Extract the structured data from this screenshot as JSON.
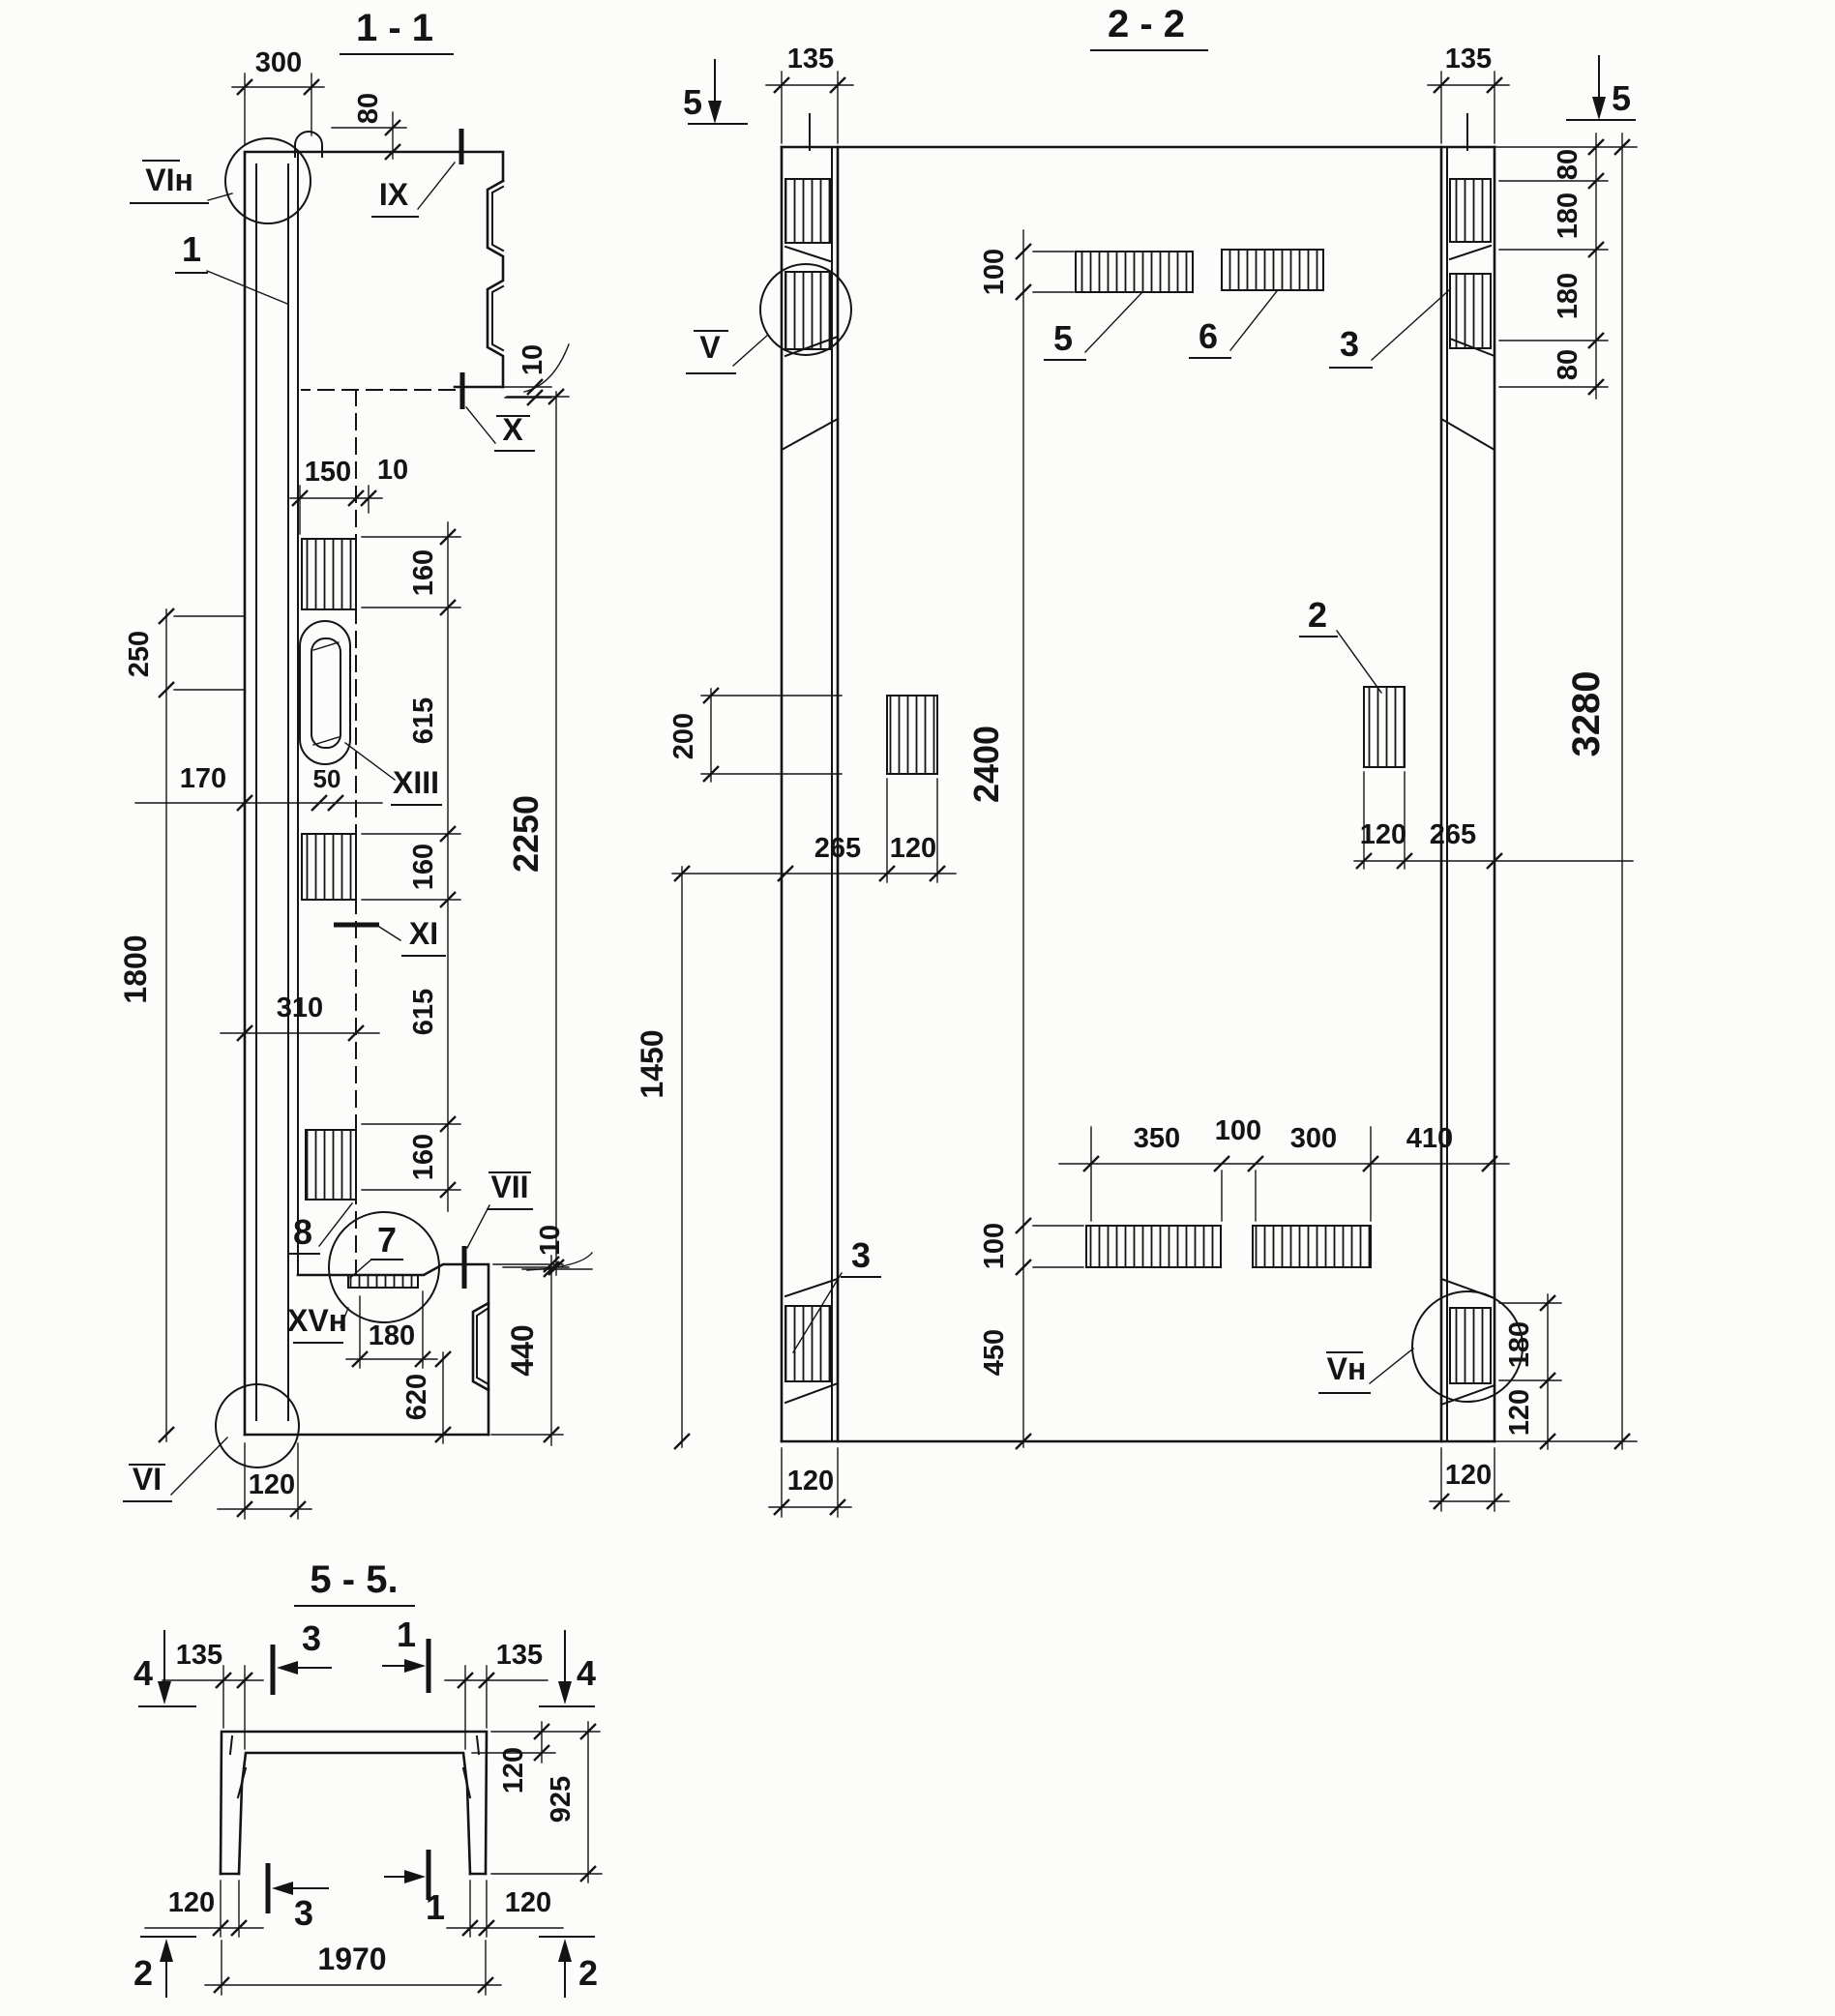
{
  "s11": {
    "title": "1 - 1",
    "d300": "300",
    "d80": "80",
    "vi_n": "VIн",
    "l1": "1",
    "ix": "IX",
    "d10a": "10",
    "x": "X",
    "d150": "150",
    "d10b": "10",
    "d160a": "160",
    "d615a": "615",
    "d160b": "160",
    "d615b": "615",
    "d160c": "160",
    "d2250": "2250",
    "d250": "250",
    "d1800": "1800",
    "d170": "170",
    "d50": "50",
    "xiii": "XIII",
    "xi": "XI",
    "d310": "310",
    "l8": "8",
    "l7": "7",
    "vii": "VII",
    "xv_n": "XVн",
    "d180": "180",
    "d620": "620",
    "d440": "440",
    "d10c": "10",
    "vi": "VI",
    "d120": "120"
  },
  "s22": {
    "title": "2 - 2",
    "s5l": "5",
    "s5r": "5",
    "d135l": "135",
    "d135r": "135",
    "d80a": "80",
    "d180a": "180",
    "d180b": "180",
    "d80b": "80",
    "d3280": "3280",
    "d100t": "100",
    "d2400": "2400",
    "d100b": "100",
    "d450": "450",
    "l5": "5",
    "l6": "6",
    "l3r": "3",
    "v": "V",
    "d200": "200",
    "d265l": "265",
    "d120l": "120",
    "d1450": "1450",
    "l2": "2",
    "d120r": "120",
    "d265r": "265",
    "d350": "350",
    "d100g": "100",
    "d300": "300",
    "d410": "410",
    "l3l": "3",
    "vn": "Vн",
    "d180c": "180",
    "d120c": "120",
    "d120bl": "120",
    "d120br": "120"
  },
  "s55": {
    "title": "5 - 5.",
    "s4l": "4",
    "s4r": "4",
    "d135l": "135",
    "d135r": "135",
    "s3t": "3",
    "s1t": "1",
    "d120t": "120",
    "d925": "925",
    "d120bl": "120",
    "s3b": "3",
    "s1b": "1",
    "d120br": "120",
    "d1970": "1970",
    "s2l": "2",
    "s2r": "2"
  }
}
